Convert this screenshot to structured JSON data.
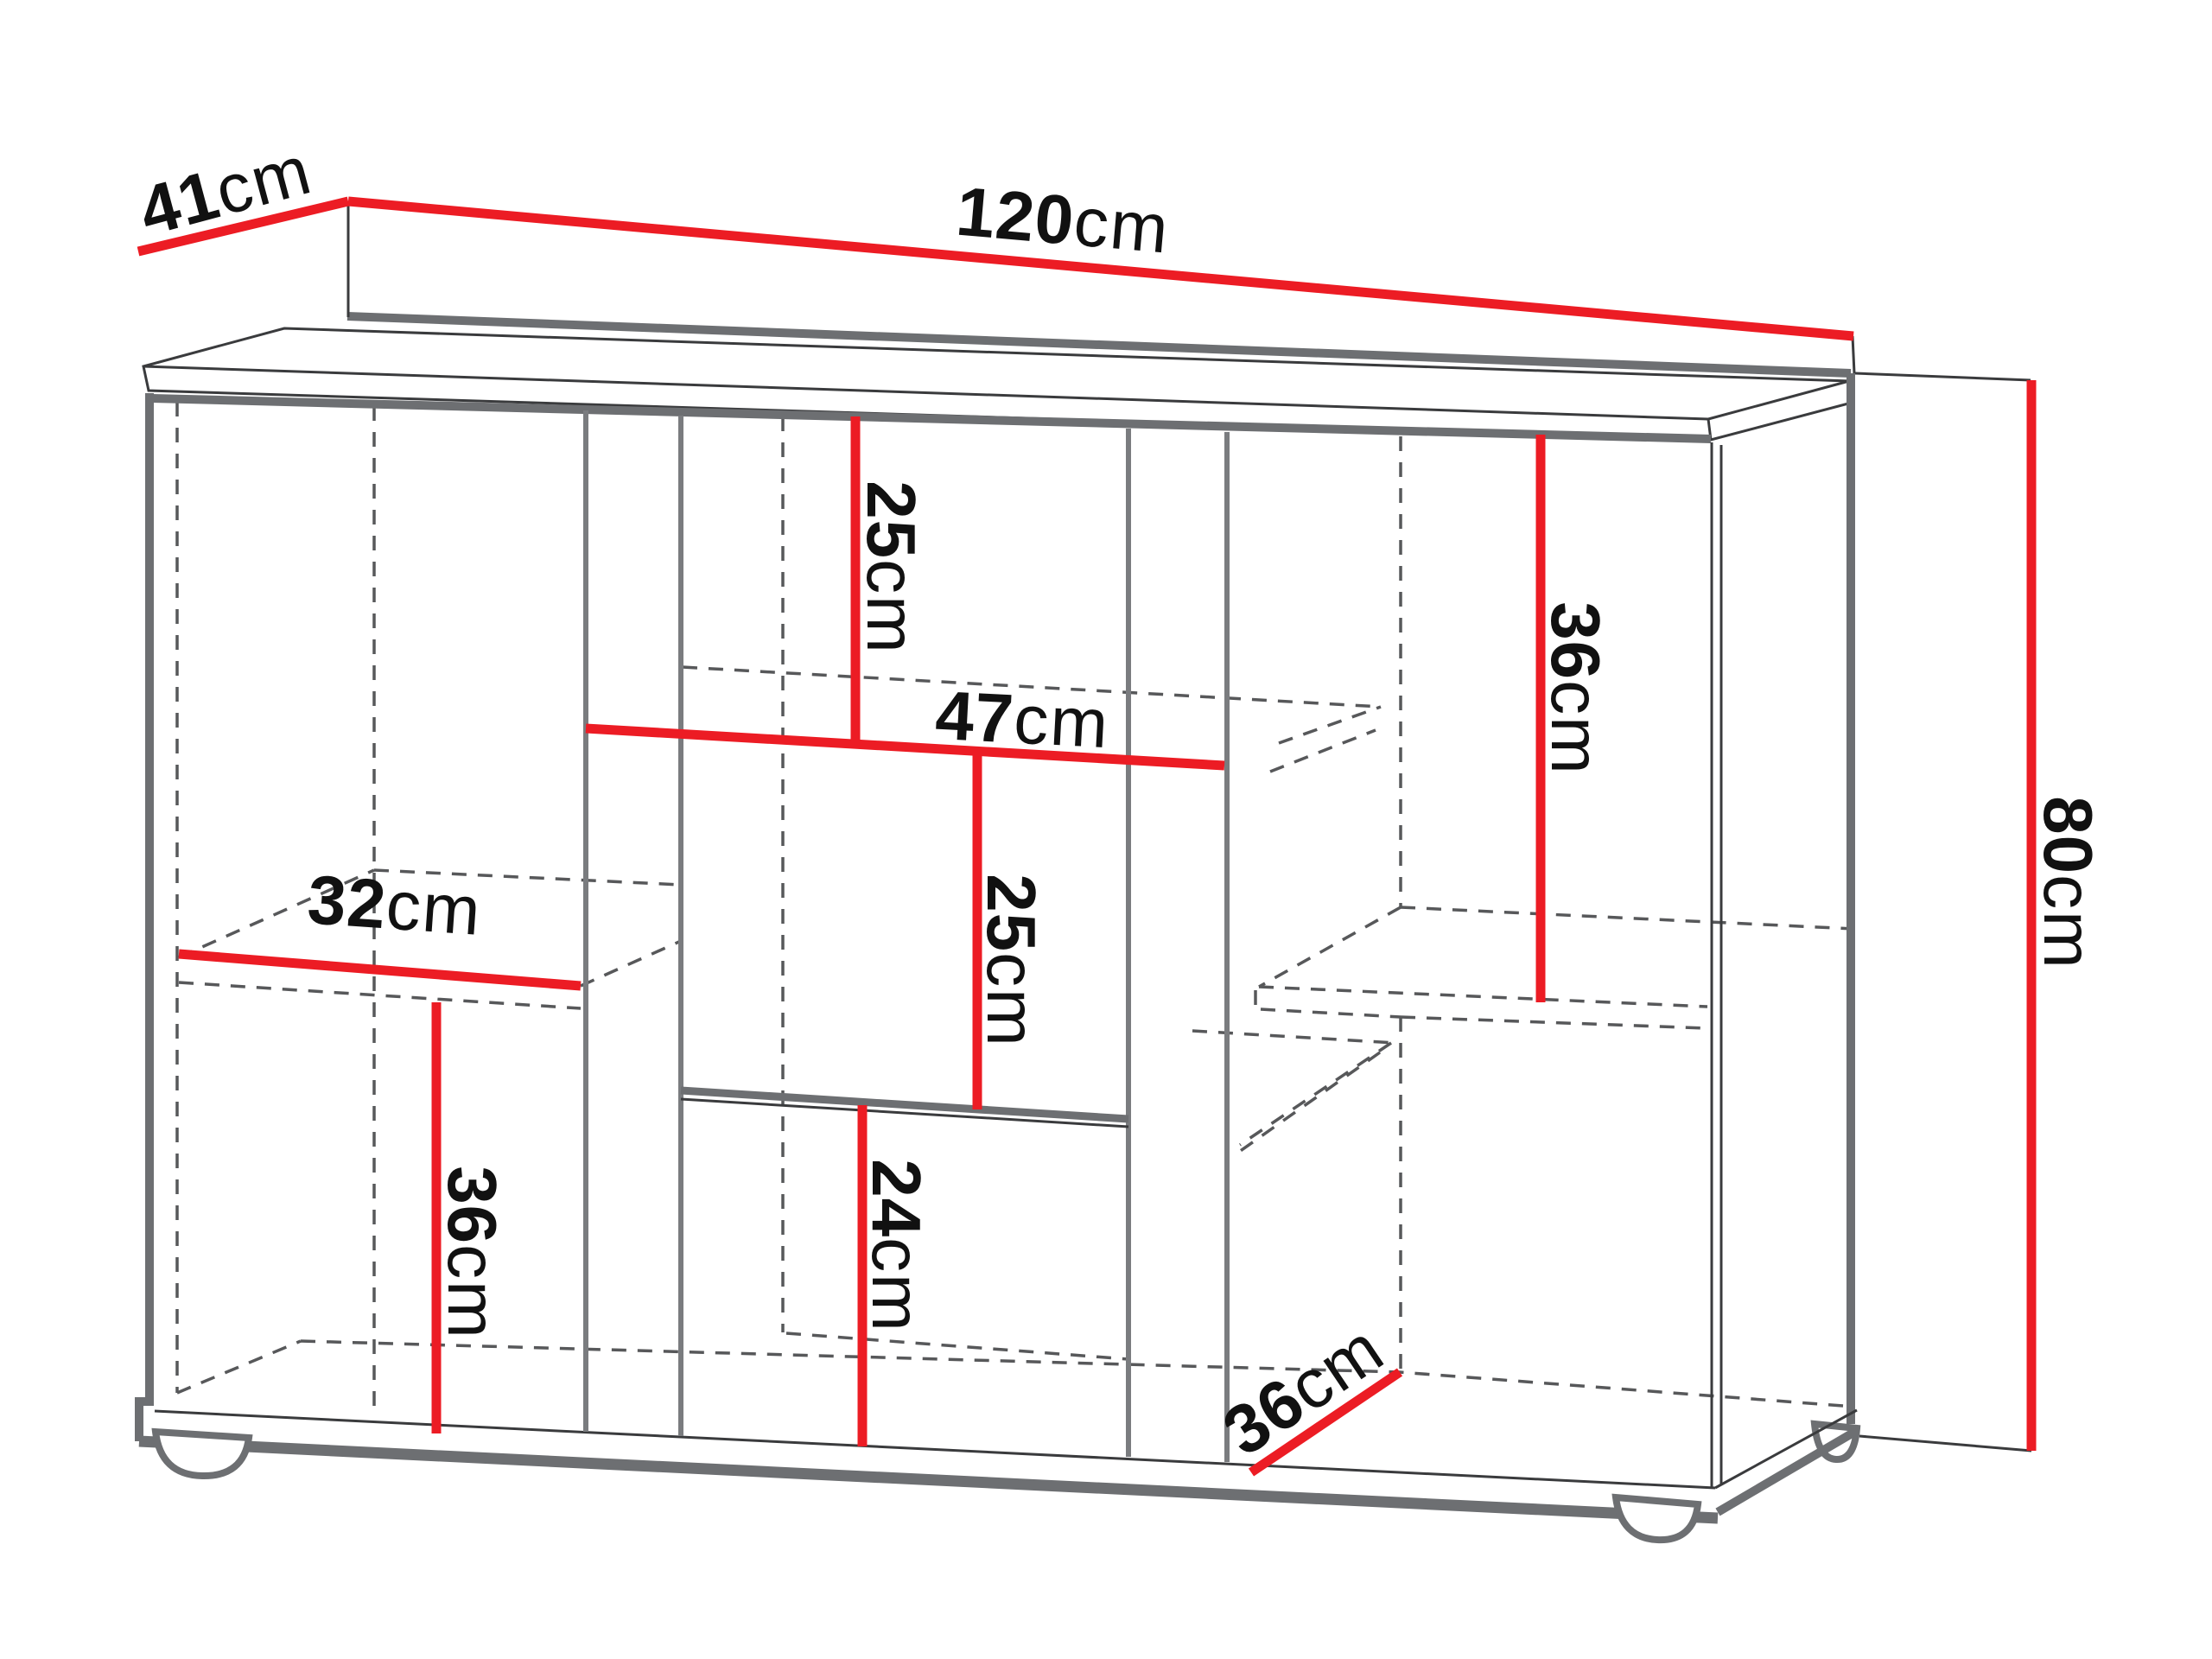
{
  "diagram": {
    "type": "furniture-dimension-drawing",
    "subject": "sideboard cabinet with staggered shelves, isometric line drawing",
    "unit": "cm",
    "colors": {
      "dimension_line": "#ec1c24",
      "structure_gray": "#6d6f72",
      "hidden_edge_gray": "#57585a",
      "text": "#111111",
      "background": "#ffffff"
    },
    "dimensions": {
      "depth": {
        "value": "41",
        "unit": "cm"
      },
      "width": {
        "value": "120",
        "unit": "cm"
      },
      "height": {
        "value": "80",
        "unit": "cm"
      },
      "top_compartment": {
        "value": "25",
        "unit": "cm"
      },
      "middle_shelf_width": {
        "value": "47",
        "unit": "cm"
      },
      "middle_compartment": {
        "value": "25",
        "unit": "cm"
      },
      "right_compartment": {
        "value": "36",
        "unit": "cm"
      },
      "left_shelf_width": {
        "value": "32",
        "unit": "cm"
      },
      "left_compartment": {
        "value": "36",
        "unit": "cm"
      },
      "bottom_compartment": {
        "value": "24",
        "unit": "cm"
      },
      "bottom_shelf_depth": {
        "value": "36",
        "unit": "cm"
      }
    }
  }
}
